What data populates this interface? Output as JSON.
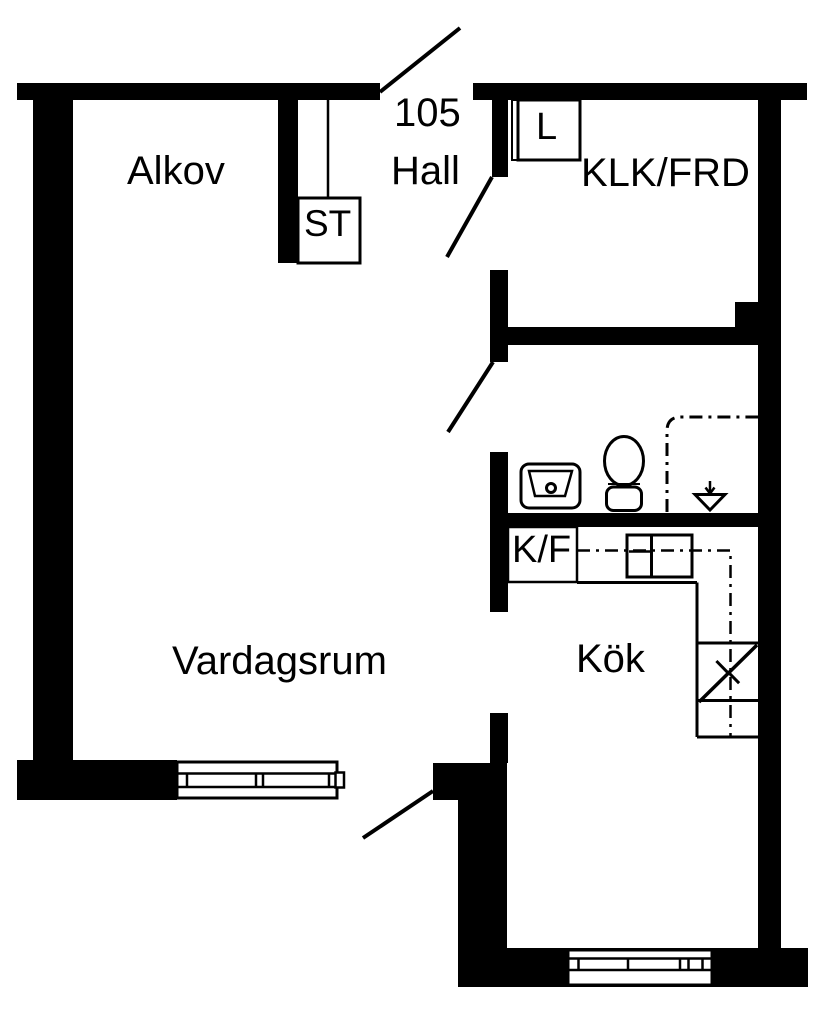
{
  "plan": {
    "apartment_number": "105",
    "rooms": {
      "alkov": "Alkov",
      "hall": "Hall",
      "klk_frd": "KLK/FRD",
      "vardagsrum": "Vardagsrum",
      "kok": "Kök"
    },
    "closets": {
      "st": "ST",
      "l": "L",
      "kf": "K/F"
    },
    "icons": {
      "toilet": "toilet-icon",
      "sink": "sink-icon",
      "shower_drain": "shower-drain-icon",
      "stove": "stove-icon",
      "counter": "kitchen-counter",
      "window": "window-symbol",
      "door_swing": "door-swing-line",
      "utility_boundary": "dash-dot-line"
    },
    "colors": {
      "wall": "#000000",
      "line": "#000000",
      "background": "#ffffff"
    }
  }
}
